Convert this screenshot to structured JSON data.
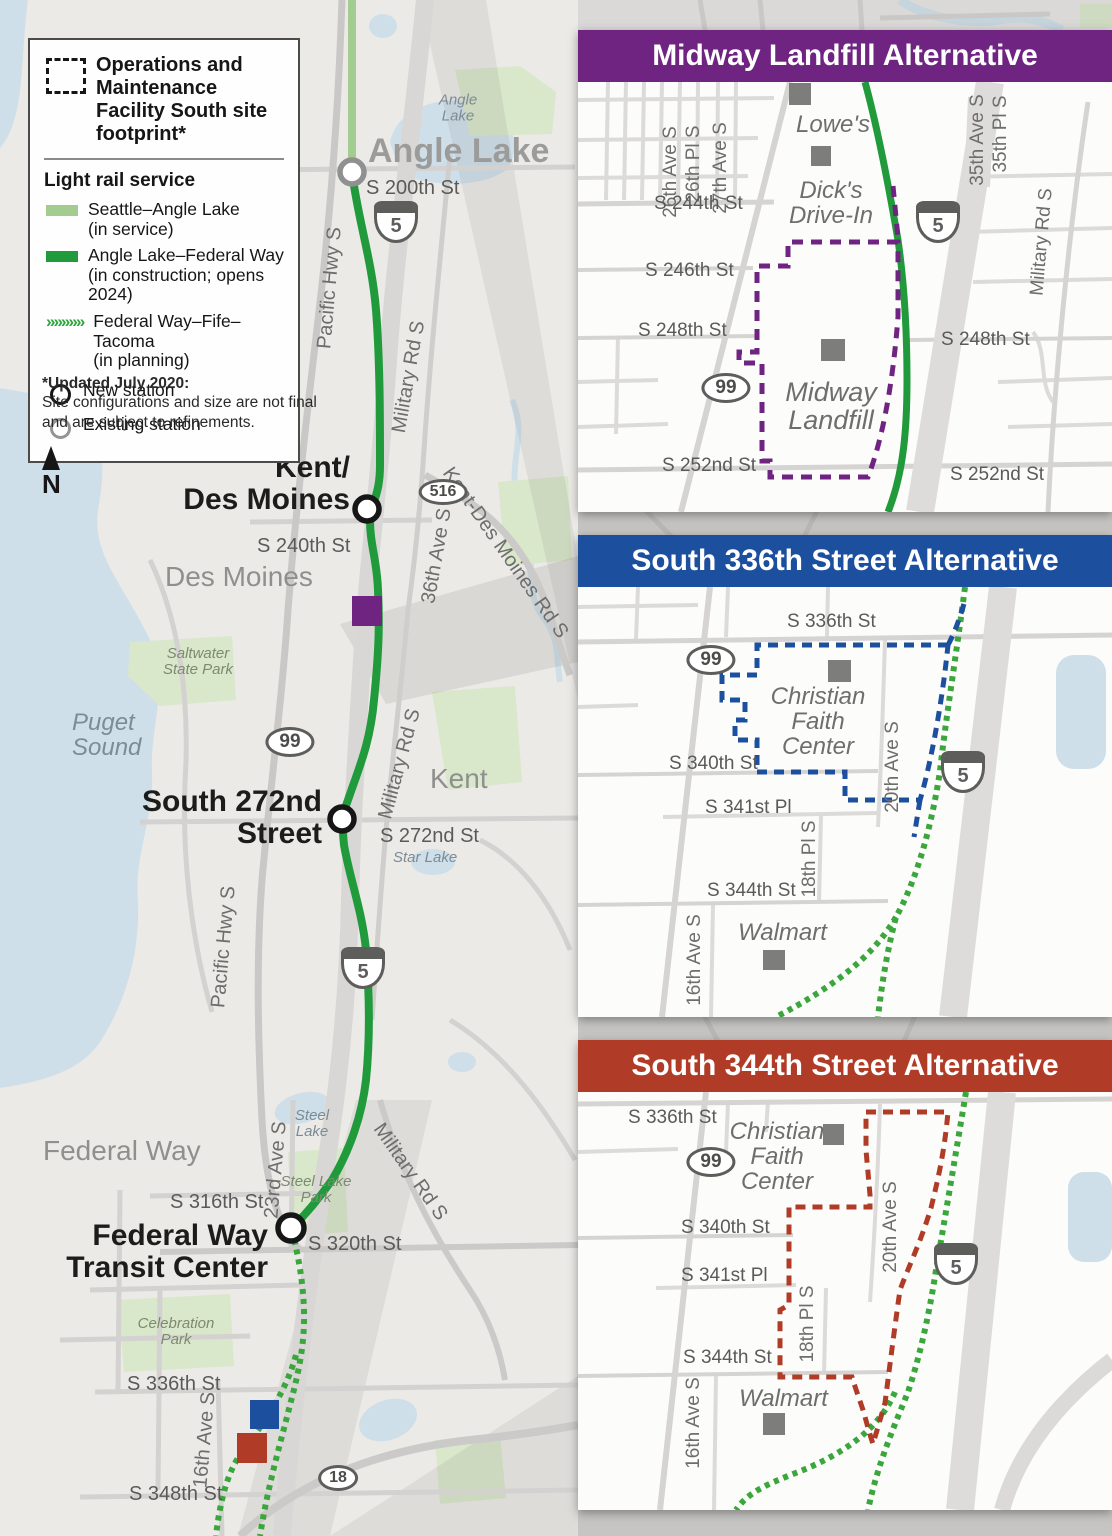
{
  "colors": {
    "midway_purple": "#6f2482",
    "s336_blue": "#1d4f9f",
    "s344_red": "#b03b26",
    "rail_in_service_green": "#a3cd90",
    "rail_construction_green": "#219a3c",
    "rail_planning_green": "#3aa63c",
    "water_blue": "#cfdfe9",
    "park_green": "#d9e7ca",
    "poi_gray": "#7d7d7b"
  },
  "legend": {
    "footprint_label": "Operations and Maintenance Facility South site footprint*",
    "section_title": "Light rail service",
    "chevron_glyphs": "»»»»»",
    "items": [
      {
        "label": "Seattle–Angle Lake",
        "sublabel": "(in service)"
      },
      {
        "label": "Angle Lake–Federal Way",
        "sublabel": "(in construction; opens 2024)"
      },
      {
        "label": "Federal Way–Fife–Tacoma",
        "sublabel": "(in planning)"
      }
    ],
    "station_items": [
      {
        "label": "New station"
      },
      {
        "label": "Existing station"
      }
    ]
  },
  "note": {
    "title": "*Updated July 2020:",
    "line1": "Site configurations and size are not final",
    "line2": "and are subject to refinements."
  },
  "north_label": "N",
  "shields": {
    "i5": "5",
    "r99": "99",
    "r516": "516",
    "r18": "18"
  },
  "main_map": {
    "stations": {
      "angle_lake": "Angle Lake",
      "kdm1": "Kent/",
      "kdm2": "Des Moines",
      "s272a": "South 272nd",
      "s272b": "Street",
      "fw1": "Federal Way",
      "fw2": "Transit Center"
    },
    "streets": {
      "s200": "S 200th St",
      "s240": "S 240th St",
      "s272": "S 272nd St",
      "s316": "S 316th St",
      "s320": "S 320th St",
      "s336": "S 336th St",
      "s348": "S 348th St"
    },
    "roads": {
      "pacific": "Pacific Hwy S",
      "military": "Military Rd S",
      "ave36": "36th Ave S",
      "kdm_rd": "Kent-Des Moines Rd S",
      "ave23": "23rd Ave S",
      "ave16": "16th Ave S"
    },
    "cities": {
      "des_moines": "Des Moines",
      "kent": "Kent",
      "federal_way": "Federal Way"
    },
    "places": {
      "angle1": "Angle",
      "angle2": "Lake",
      "puget1": "Puget",
      "puget2": "Sound",
      "salt1": "Saltwater",
      "salt2": "State Park",
      "star": "Star Lake",
      "steel1": "Steel",
      "steel2": "Lake",
      "steelpark1": "Steel Lake",
      "steelpark2": "Park",
      "celeb1": "Celebration",
      "celeb2": "Park"
    }
  },
  "insets": [
    {
      "title": "Midway Landfill Alternative",
      "labels": {
        "ave26": "26th Ave S",
        "pl26": "26th Pl S",
        "ave27": "27th Ave S",
        "s244": "S 244th St",
        "s246": "S 246th St",
        "s248": "S 248th St",
        "s252": "S 252nd St",
        "lowes": "Lowe's",
        "dicks1": "Dick's",
        "dicks2": "Drive-In",
        "midway1": "Midway",
        "midway2": "Landfill",
        "ave35": "35th Ave S",
        "pl35": "35th Pl S",
        "military": "Military Rd S"
      }
    },
    {
      "title": "South 336th Street Alternative",
      "labels": {
        "s336": "S 336th St",
        "s340": "S 340th St",
        "s341": "S 341st Pl",
        "s344": "S 344th St",
        "cfc1": "Christian",
        "cfc2": "Faith",
        "cfc3": "Center",
        "ave20": "20th Ave S",
        "pl18": "18th Pl S",
        "ave16": "16th Ave S",
        "walmart": "Walmart"
      }
    },
    {
      "title": "South 344th Street Alternative",
      "labels": {
        "s336": "S 336th St",
        "s340": "S 340th St",
        "s341": "S 341st Pl",
        "s344": "S 344th St",
        "cfc1": "Christian",
        "cfc2": "Faith",
        "cfc3": "Center",
        "ave20": "20th Ave S",
        "pl18": "18th Pl S",
        "ave16": "16th Ave S",
        "walmart": "Walmart"
      }
    }
  ]
}
